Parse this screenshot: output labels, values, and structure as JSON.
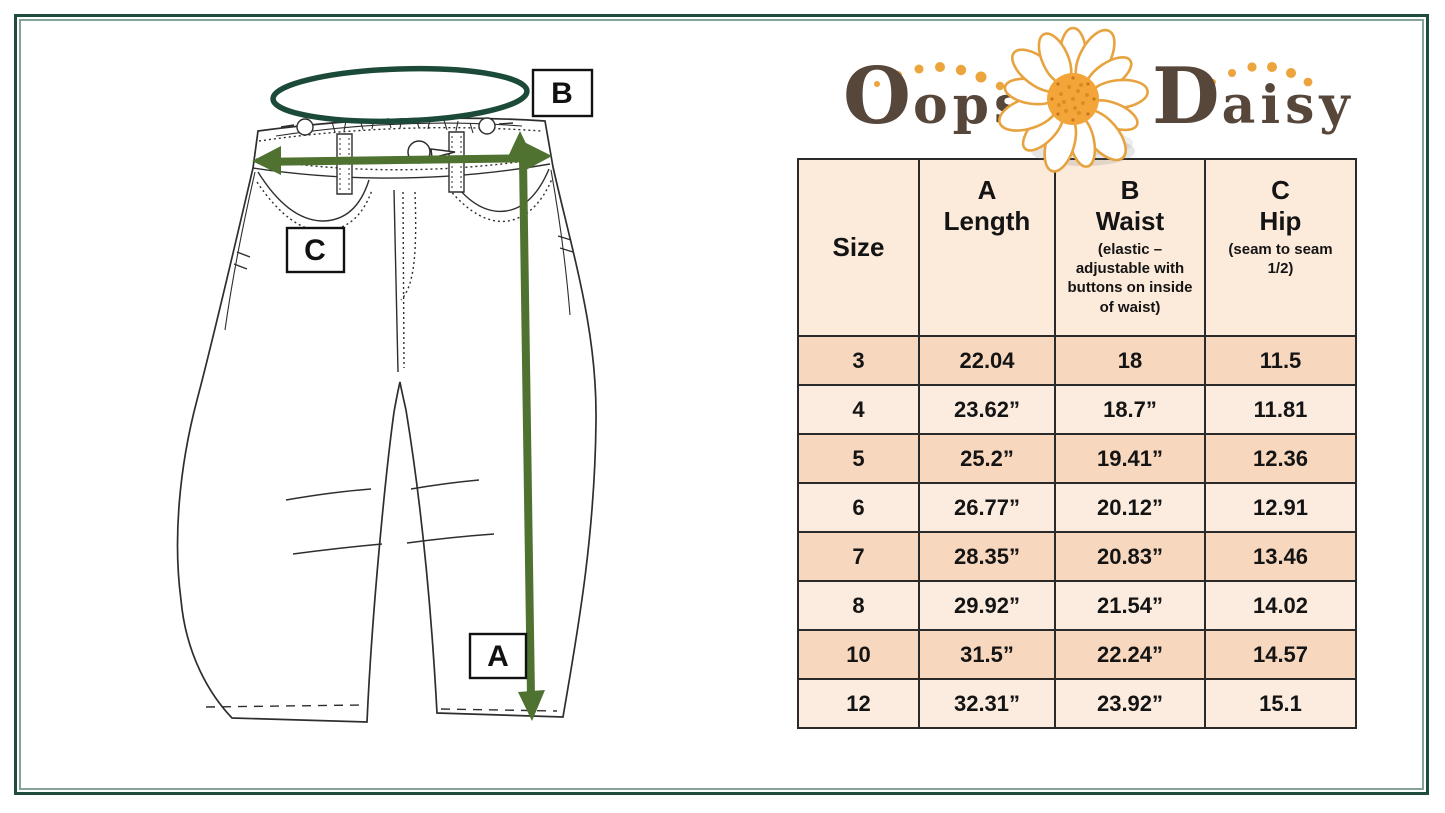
{
  "logo": {
    "word1": "Oopsie",
    "word2": "Daisy",
    "text_color": "#57463a",
    "accent_orange": "#eca43c"
  },
  "diagram": {
    "label_a": "A",
    "label_b": "B",
    "label_c": "C",
    "arrow_color": "#4f7231",
    "waist_ellipse_color": "#1c4a38",
    "line_art_color": "#2e2e2e"
  },
  "table": {
    "columns": [
      {
        "letter": "",
        "label": "Size",
        "note": ""
      },
      {
        "letter": "A",
        "label": "Length",
        "note": ""
      },
      {
        "letter": "B",
        "label": "Waist",
        "note": "(elastic – adjustable with buttons on inside of waist)"
      },
      {
        "letter": "C",
        "label": "Hip",
        "note": "(seam to seam 1/2)"
      }
    ],
    "rows": [
      [
        "3",
        "22.04",
        "18",
        "11.5"
      ],
      [
        "4",
        "23.62”",
        "18.7”",
        "11.81"
      ],
      [
        "5",
        "25.2”",
        "19.41”",
        "12.36"
      ],
      [
        "6",
        "26.77”",
        "20.12”",
        "12.91"
      ],
      [
        "7",
        "28.35”",
        "20.83”",
        "13.46"
      ],
      [
        "8",
        "29.92”",
        "21.54”",
        "14.02"
      ],
      [
        "10",
        "31.5”",
        "22.24”",
        "14.57"
      ],
      [
        "12",
        "32.31”",
        "23.92”",
        "15.1"
      ]
    ],
    "colors": {
      "row_shaded": "#f7d8bf",
      "row_plain": "#fcecdf",
      "header_bg": "#fceadb",
      "grid": "#2a2a2a"
    }
  },
  "frame_color": "#1e4d3b"
}
